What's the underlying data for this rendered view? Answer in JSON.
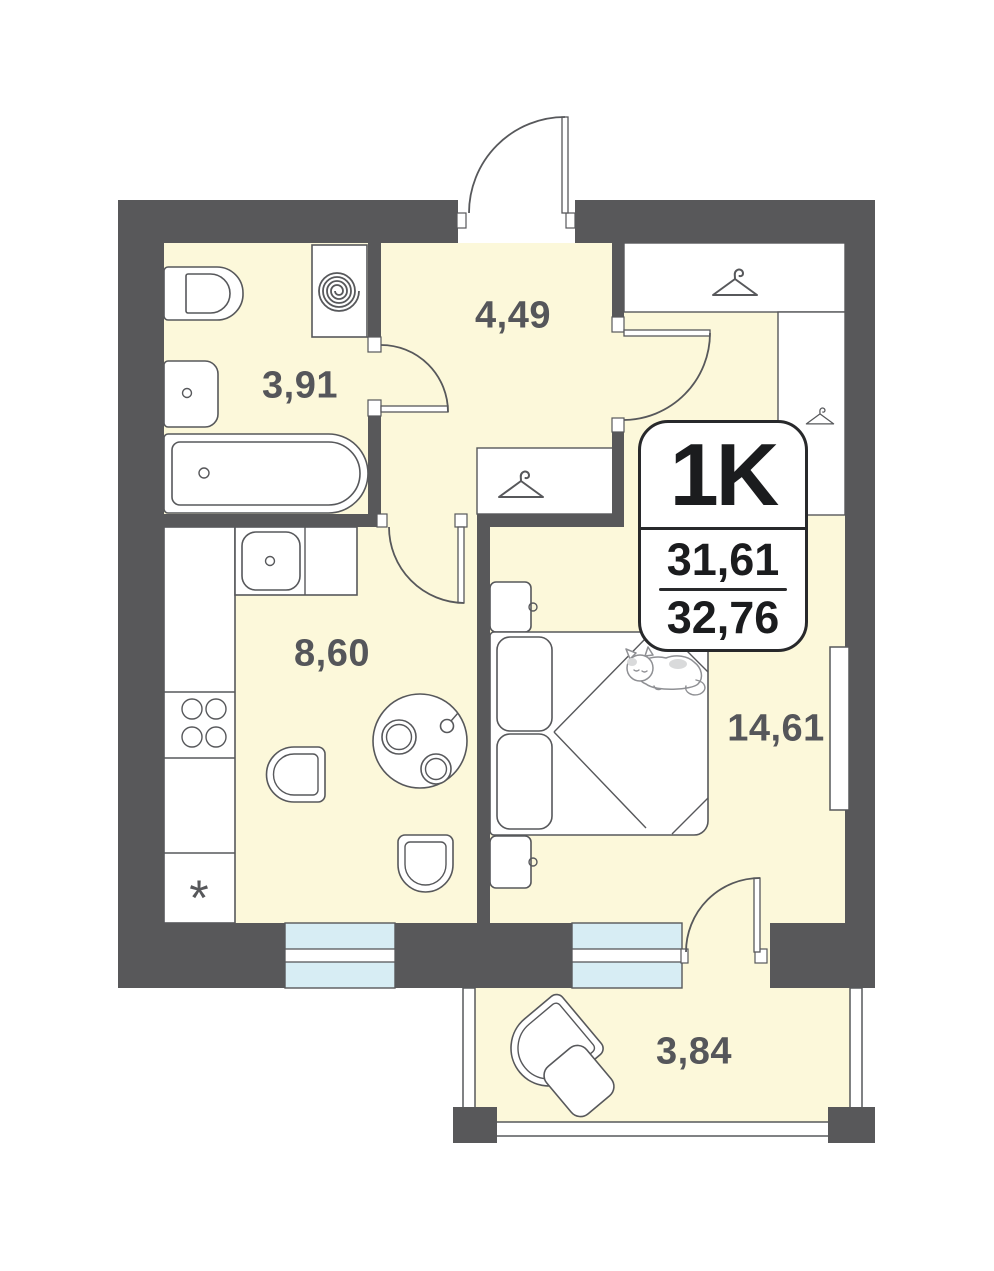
{
  "plan": {
    "badge": {
      "unit": "1K",
      "living_area": "31,61",
      "total_area": "32,76"
    },
    "rooms": [
      {
        "name": "bathroom",
        "area": "3,91"
      },
      {
        "name": "hallway",
        "area": "4,49"
      },
      {
        "name": "kitchen",
        "area": "8,60"
      },
      {
        "name": "bedroom",
        "area": "14,61"
      },
      {
        "name": "balcony",
        "area": "3,84"
      }
    ],
    "symbols": {
      "fridge": "*"
    },
    "colors": {
      "wall": "#58585a",
      "floor": "#fcf8da",
      "window": "#d7edf4",
      "line": "#57585b",
      "badge_border": "#28292b",
      "label": "#55565a"
    }
  }
}
